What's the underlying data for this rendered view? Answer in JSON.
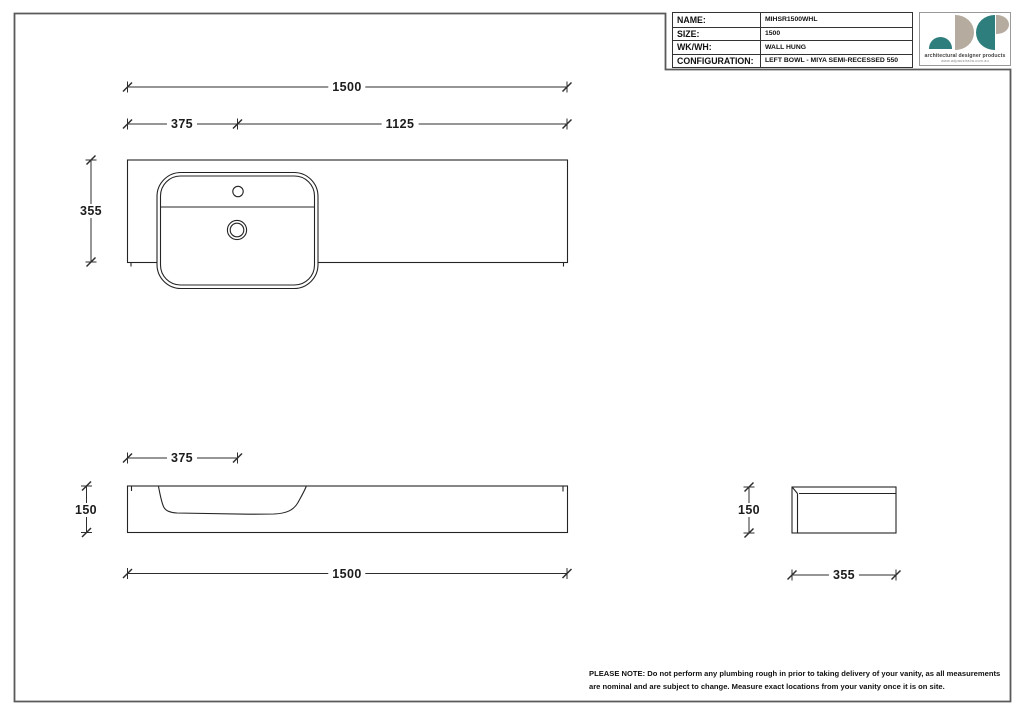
{
  "title_block": {
    "rows": [
      {
        "label": "NAME:",
        "value": "MIHSR1500WHL"
      },
      {
        "label": "SIZE:",
        "value": "1500"
      },
      {
        "label": "WK/WH:",
        "value": "WALL HUNG"
      },
      {
        "label": "CONFIGURATION:",
        "value": "LEFT BOWL - MIYA SEMI-RECESSED 550"
      }
    ]
  },
  "logo": {
    "tagline": "architectural designer products",
    "website": "www.adpaustralia.com.au",
    "colors": {
      "teal": "#2e7e7e",
      "beige": "#b5ab9f"
    }
  },
  "drawing": {
    "views": {
      "plan": {
        "dims": {
          "overall_width": "1500",
          "bowl_centre": "375",
          "remainder": "1125",
          "depth": "355"
        }
      },
      "front": {
        "dims": {
          "bowl_offset": "375",
          "height": "150",
          "overall_width": "1500"
        }
      },
      "side": {
        "dims": {
          "height": "150",
          "depth": "355"
        }
      }
    }
  },
  "note": "PLEASE NOTE: Do not perform any plumbing rough in prior to taking delivery of your vanity, as all measurements are nominal and are subject to change. Measure exact locations from your vanity once it is on site."
}
